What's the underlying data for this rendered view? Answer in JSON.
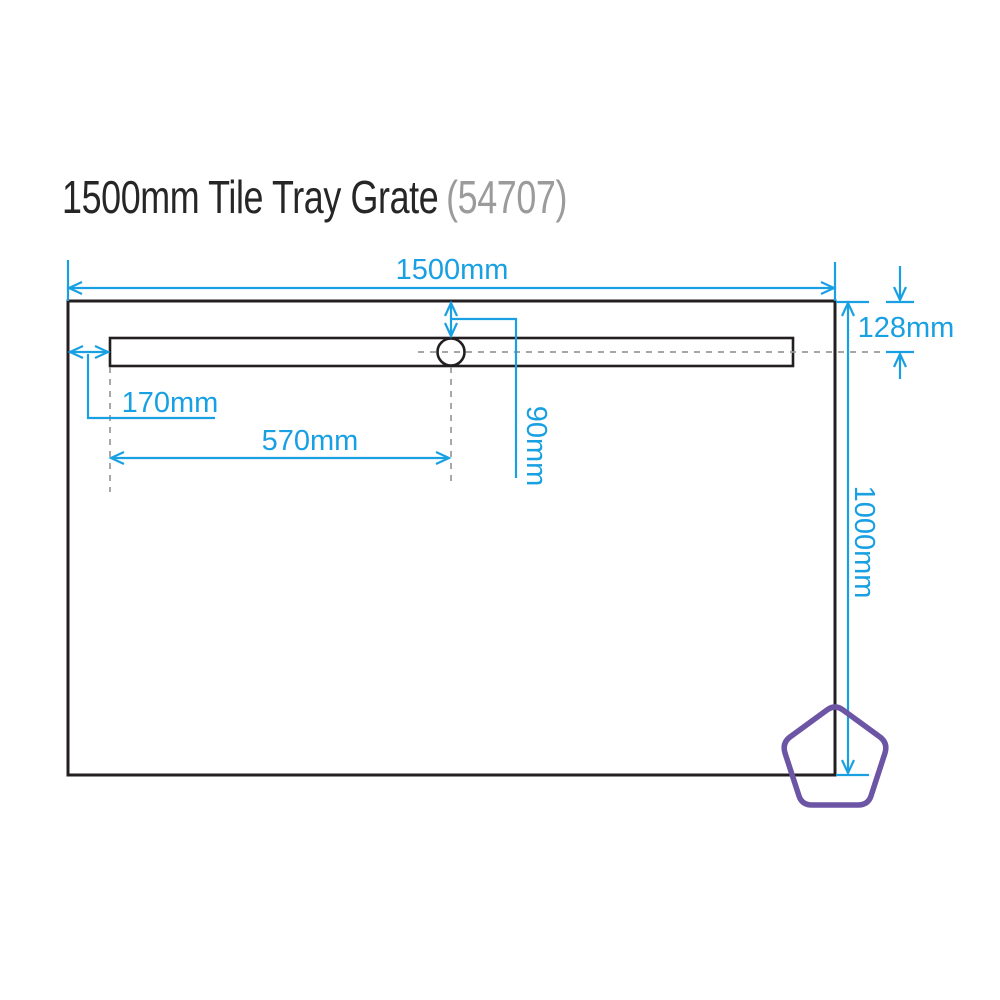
{
  "title": {
    "product": "1500mm Tile Tray Grate",
    "code": "(54707)"
  },
  "diagram": {
    "description": "Plan-view technical drawing of a rectangular tile tray with a linear grate slot, circular drain outlet and dimension callouts",
    "dimensions": {
      "tray_width": "1500mm",
      "tray_depth": "1000mm",
      "grate_centre_from_top": "128mm",
      "slot_offset_from_left_edge": "170mm",
      "drain_centre_from_slot_start": "570mm",
      "drain_centre_from_top_edge": "90mm"
    }
  },
  "colors": {
    "accent": "#19A0E3",
    "pentagon": "#6C55A5",
    "line": "#231F20",
    "dash": "#999999",
    "title_text": "#262626",
    "title_code": "#9B9B9B"
  }
}
